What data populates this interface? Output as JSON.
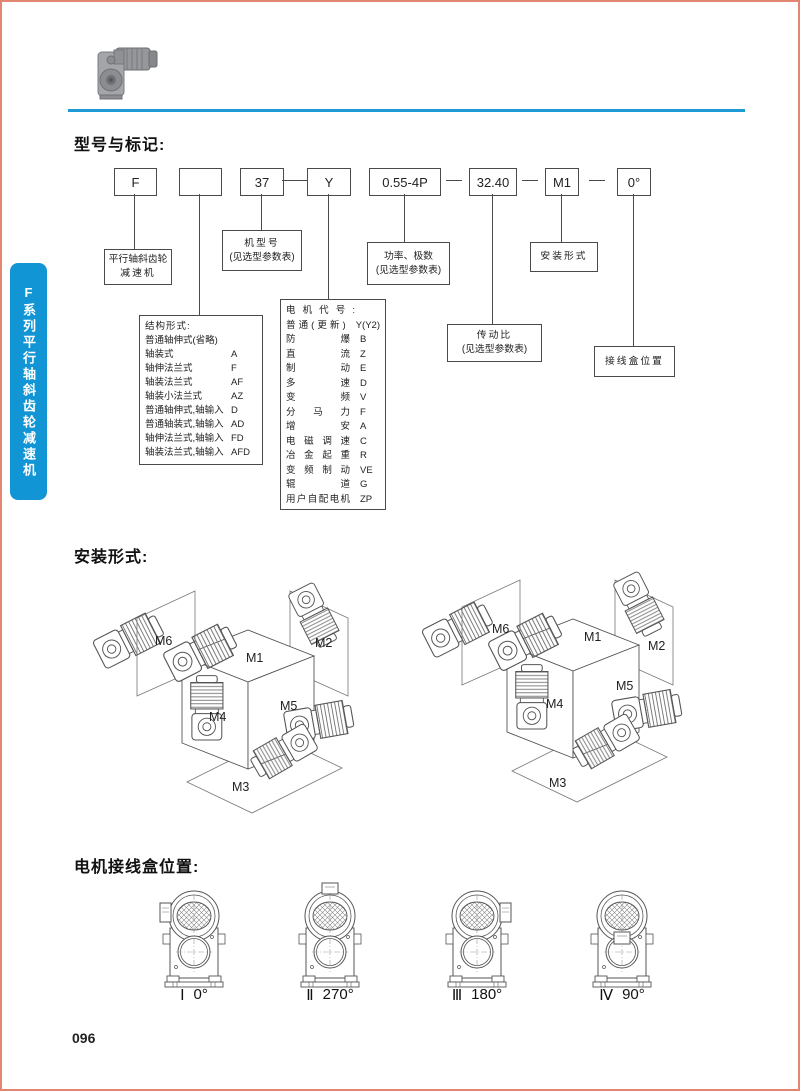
{
  "page": {
    "number": "096"
  },
  "sidebar": {
    "label": "F系列平行轴斜齿轮减速机"
  },
  "colors": {
    "accent_blue": "#1295d5",
    "rule_blue": "#1e9ad6",
    "border_salmon": "#e28672"
  },
  "model_section": {
    "title": "型号与标记:",
    "code_boxes": [
      "F",
      "",
      "37",
      "Y",
      "0.55-4P",
      "32.40",
      "M1",
      "0°"
    ],
    "callouts": {
      "reducer_line1": "平行轴斜齿轮",
      "reducer_line2": "减速机",
      "frame_line1": "机型号",
      "frame_line2": "(见选型参数表)",
      "power_line1": "功率、极数",
      "power_line2": "(见选型参数表)",
      "mount": "安装形式",
      "ratio_line1": "传动比",
      "ratio_line2": "(见选型参数表)",
      "terminal": "接线盒位置"
    },
    "structure_list": {
      "title": "结构形式:",
      "items": [
        {
          "name": "普通轴伸式(省略)",
          "code": ""
        },
        {
          "name": "轴装式",
          "code": "A"
        },
        {
          "name": "轴伸法兰式",
          "code": "F"
        },
        {
          "name": "轴装法兰式",
          "code": "AF"
        },
        {
          "name": "轴装小法兰式",
          "code": "AZ"
        },
        {
          "name": "普通轴伸式,轴输入",
          "code": "D"
        },
        {
          "name": "普通轴装式,轴输入",
          "code": "AD"
        },
        {
          "name": "轴伸法兰式,轴输入",
          "code": "FD"
        },
        {
          "name": "轴装法兰式,轴输入",
          "code": "AFD"
        }
      ]
    },
    "motor_list": {
      "title": "电机代号:",
      "items": [
        {
          "name": "普通(更新)",
          "code": "Y(Y2)"
        },
        {
          "name": "防爆",
          "code": "B"
        },
        {
          "name": "直流",
          "code": "Z"
        },
        {
          "name": "制动",
          "code": "E"
        },
        {
          "name": "多速",
          "code": "D"
        },
        {
          "name": "变频",
          "code": "V"
        },
        {
          "name": "分马力",
          "code": "F"
        },
        {
          "name": "增安",
          "code": "A"
        },
        {
          "name": "电磁调速",
          "code": "C"
        },
        {
          "name": "冶金起重",
          "code": "R"
        },
        {
          "name": "变频制动",
          "code": "VE"
        },
        {
          "name": "辊道",
          "code": "G"
        },
        {
          "name": "用户自配电机",
          "code": "ZP"
        }
      ]
    }
  },
  "mounting_section": {
    "title": "安装形式:",
    "labels": [
      "M1",
      "M2",
      "M3",
      "M4",
      "M5",
      "M6"
    ]
  },
  "terminal_section": {
    "title": "电机接线盒位置:",
    "items": [
      {
        "numeral": "Ⅰ",
        "angle": "0°"
      },
      {
        "numeral": "Ⅱ",
        "angle": "270°"
      },
      {
        "numeral": "Ⅲ",
        "angle": "180°"
      },
      {
        "numeral": "Ⅳ",
        "angle": "90°"
      }
    ]
  }
}
